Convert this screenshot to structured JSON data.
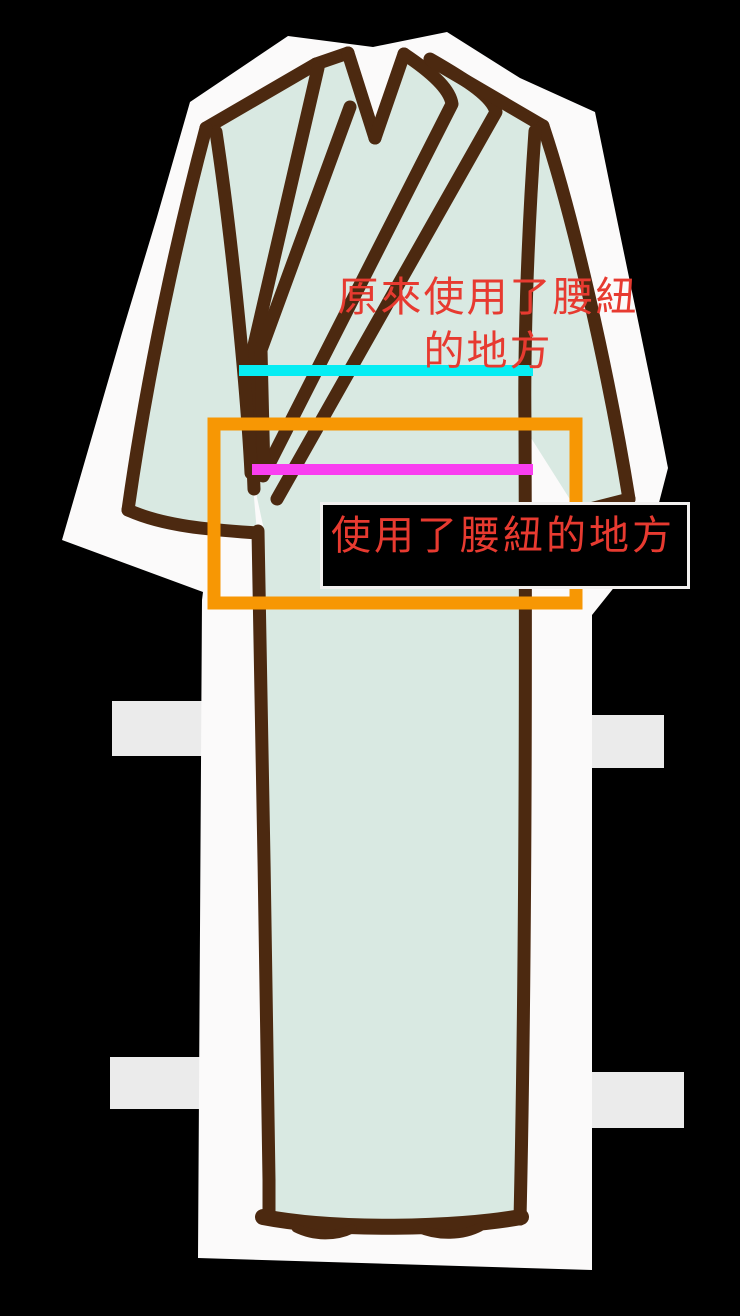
{
  "colors": {
    "background": "#000000",
    "silhouette": "#fbfafa",
    "garment": "#d9e9e2",
    "outline": "#4c2910",
    "tabs": "#ebebeb",
    "original_line": "#06edf3",
    "current_line": "#f93ef0",
    "highlight_box": "#f79704",
    "label_text": "#e73a30",
    "label_box_bg": "#000000",
    "label_box_border": "#f2f0ef"
  },
  "labels": {
    "original_spot": {
      "line1": "原來使用了腰紐",
      "line2": "的地方"
    },
    "current_spot": "使用了腰紐的地方"
  }
}
